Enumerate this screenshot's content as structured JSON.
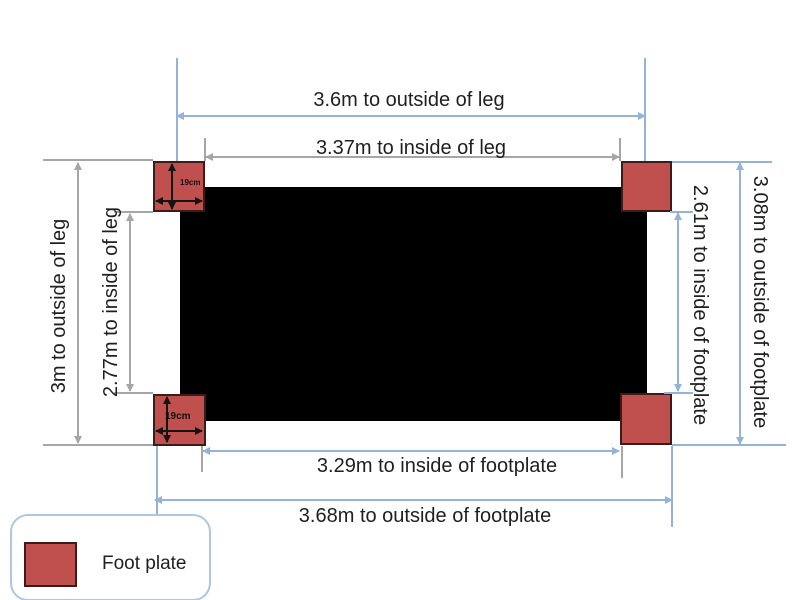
{
  "diagram": {
    "type": "dimension-diagram",
    "labels": {
      "top_outside_leg": "3.6m to outside of leg",
      "top_inside_leg": "3.37m to inside of leg",
      "left_outside_leg": "3m to outside of leg",
      "left_inside_leg": "2.77m to inside of leg",
      "right_inside_footplate": "2.61m to inside of footplate",
      "right_outside_footplate": "3.08m to outside of footplate",
      "bottom_inside_footplate": "3.29m to inside of footplate",
      "bottom_outside_footplate": "3.68m to outside of footplate",
      "footplate_size_top": "19cm",
      "footplate_size_bottom": "19cm"
    },
    "legend": {
      "footplate": "Foot plate"
    },
    "colors": {
      "footplate": "#c0504d",
      "footplate_border": "#3d1b1a",
      "bed": "#000000",
      "blue": "#95b3d7",
      "gray": "#a6a6a6",
      "text": "#1f1f1f"
    }
  }
}
